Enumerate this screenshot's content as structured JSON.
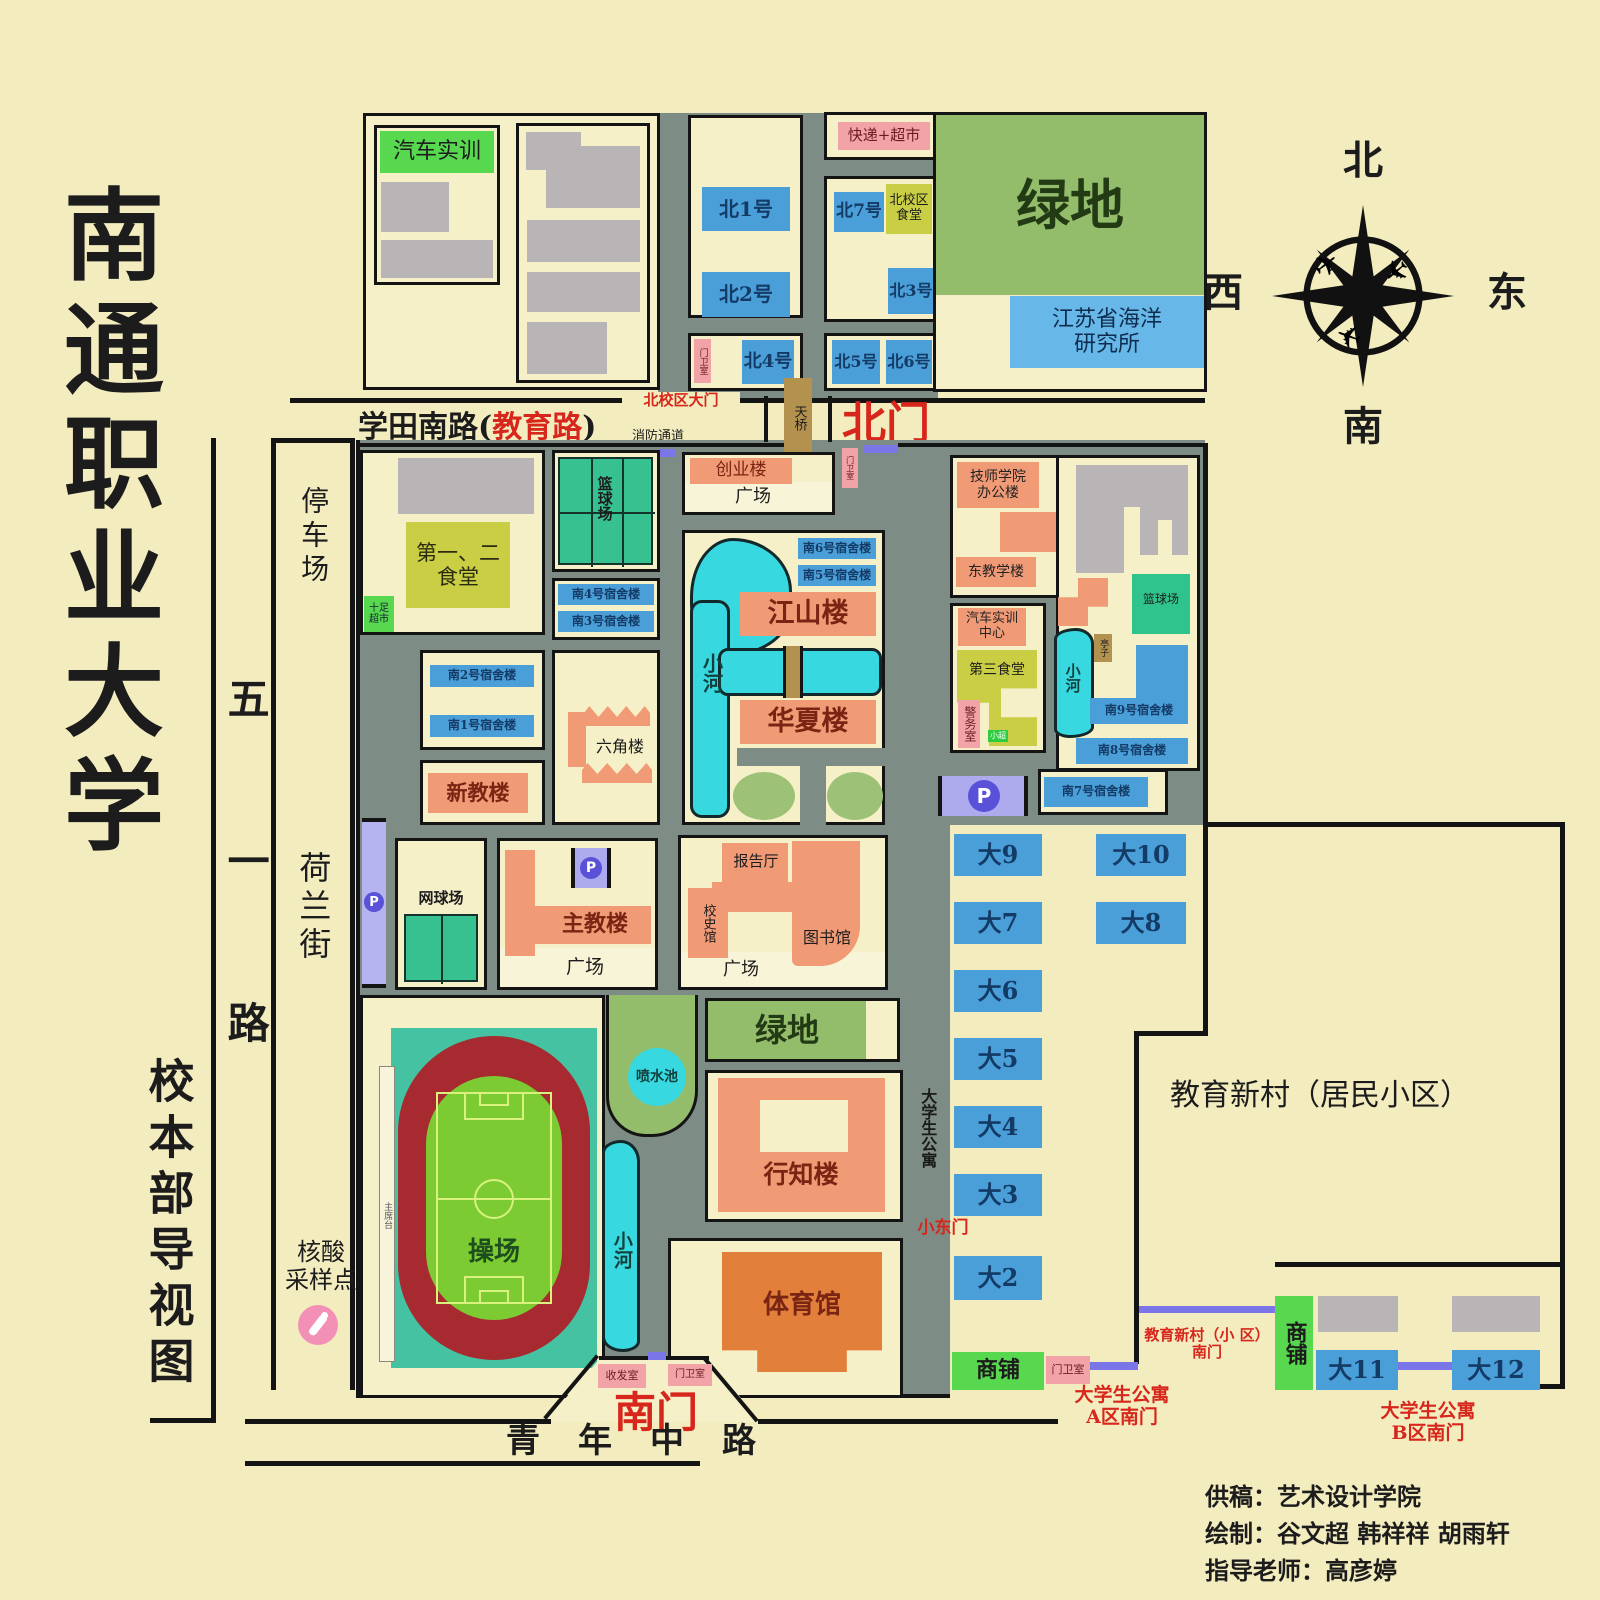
{
  "palette": {
    "background": "#f3ecbf",
    "road": "#7d8c84",
    "block_fill": "#f6f0c8",
    "building_blue": "#4a9fd8",
    "building_salmon": "#f09a76",
    "building_gray": "#b9b4b6",
    "canteen_yellow_green": "#c9ce44",
    "lawn_green": "#93bc6b",
    "bright_green": "#57d84f",
    "court_teal": "#38c190",
    "river_cyan": "#38d8e0",
    "tag_pink": "#f2a3a8",
    "parking_purple": "#aeaaee",
    "parking_circle": "#5951d8",
    "bridge_tan": "#b3914f",
    "gym_orange": "#e2803b",
    "track_red": "#a62a30",
    "field_green": "#7ccb33",
    "accent_red": "#d7261b",
    "outline_black": "#141414"
  },
  "icons": {
    "plane": "✈"
  },
  "labels": {
    "calligraphy": "南通职业大学",
    "map_caption": "校本部导视图",
    "wuyi_road": "五一路",
    "parking_lot": "停车场",
    "helan_street": "荷兰街",
    "xuetian_prefix": "学田南路(",
    "xuetian_red": "教育路",
    "xuetian_suffix": ")",
    "north_campus_gate": "北校区大门",
    "fire_lane": "消防通道",
    "north_gate": "北门",
    "footbridge": "天桥",
    "gatehouse": "门卫室",
    "mail_room": "收发室",
    "south_gate": "南门",
    "qingnian_road": "青年中路",
    "auto_training": "汽车实训",
    "bei1": "北1号",
    "bei2": "北2号",
    "bei3": "北3号",
    "bei4": "北4号",
    "bei5": "北5号",
    "bei6": "北6号",
    "bei7": "北7号",
    "express_market": "快递+超市",
    "north_canteen": "北校区\n食堂",
    "green_space": "绿地",
    "marine_institute": "江苏省海洋\n研究所",
    "compass_n": "北",
    "compass_s": "南",
    "compass_e": "东",
    "compass_w": "西",
    "canteen12": "第一、二\n食堂",
    "shizu_market": "十足\n超市",
    "basketball": "篮球场",
    "tennis": "网球场",
    "nan1": "南1号宿舍楼",
    "nan2": "南2号宿舍楼",
    "nan3": "南3号宿舍楼",
    "nan4": "南4号宿舍楼",
    "nan5": "南5号宿舍楼",
    "nan6": "南6号宿舍楼",
    "nan7": "南7号宿舍楼",
    "nan8": "南8号宿舍楼",
    "nan9": "南9号宿舍楼",
    "chuangye": "创业楼",
    "plaza": "广场",
    "jiangshan": "江山楼",
    "huaxia": "华夏楼",
    "river": "小河",
    "liujiao": "六角楼",
    "xinjiao": "新教楼",
    "zhujiao": "主教楼",
    "lecture_hall": "报告厅",
    "history_hall": "校史馆",
    "library": "图书馆",
    "playground": "操场",
    "rostrum": "主席台",
    "fountain": "喷水池",
    "xingzhi": "行知楼",
    "gym": "体育馆",
    "technician_office": "技师学院\n办公楼",
    "east_teaching": "东教学楼",
    "auto_center": "汽车实训\n中心",
    "canteen3": "第三食堂",
    "police_room": "警务室",
    "mini_market": "小超",
    "pavilion": "亭子",
    "da2": "大2",
    "da3": "大3",
    "da4": "大4",
    "da5": "大5",
    "da6": "大6",
    "da7": "大7",
    "da8": "大8",
    "da9": "大9",
    "da10": "大10",
    "da11": "大11",
    "da12": "大12",
    "student_apartment": "大学生公寓",
    "small_east_gate": "小东门",
    "jiaoyu_xincun": "教育新村（居民小区）",
    "shops": "商铺",
    "a_gate": "大学生公寓\nA区南门",
    "b_gate": "大学生公寓\nB区南门",
    "xincun_gate": "教育新村（小 区）\n南门",
    "nucleic_acid": "核酸\n采样点",
    "p": "P",
    "credit1": "供稿：艺术设计学院",
    "credit2": "绘制：谷文超  韩祥祥  胡雨轩",
    "credit3": "指导老师：高彦婷"
  }
}
